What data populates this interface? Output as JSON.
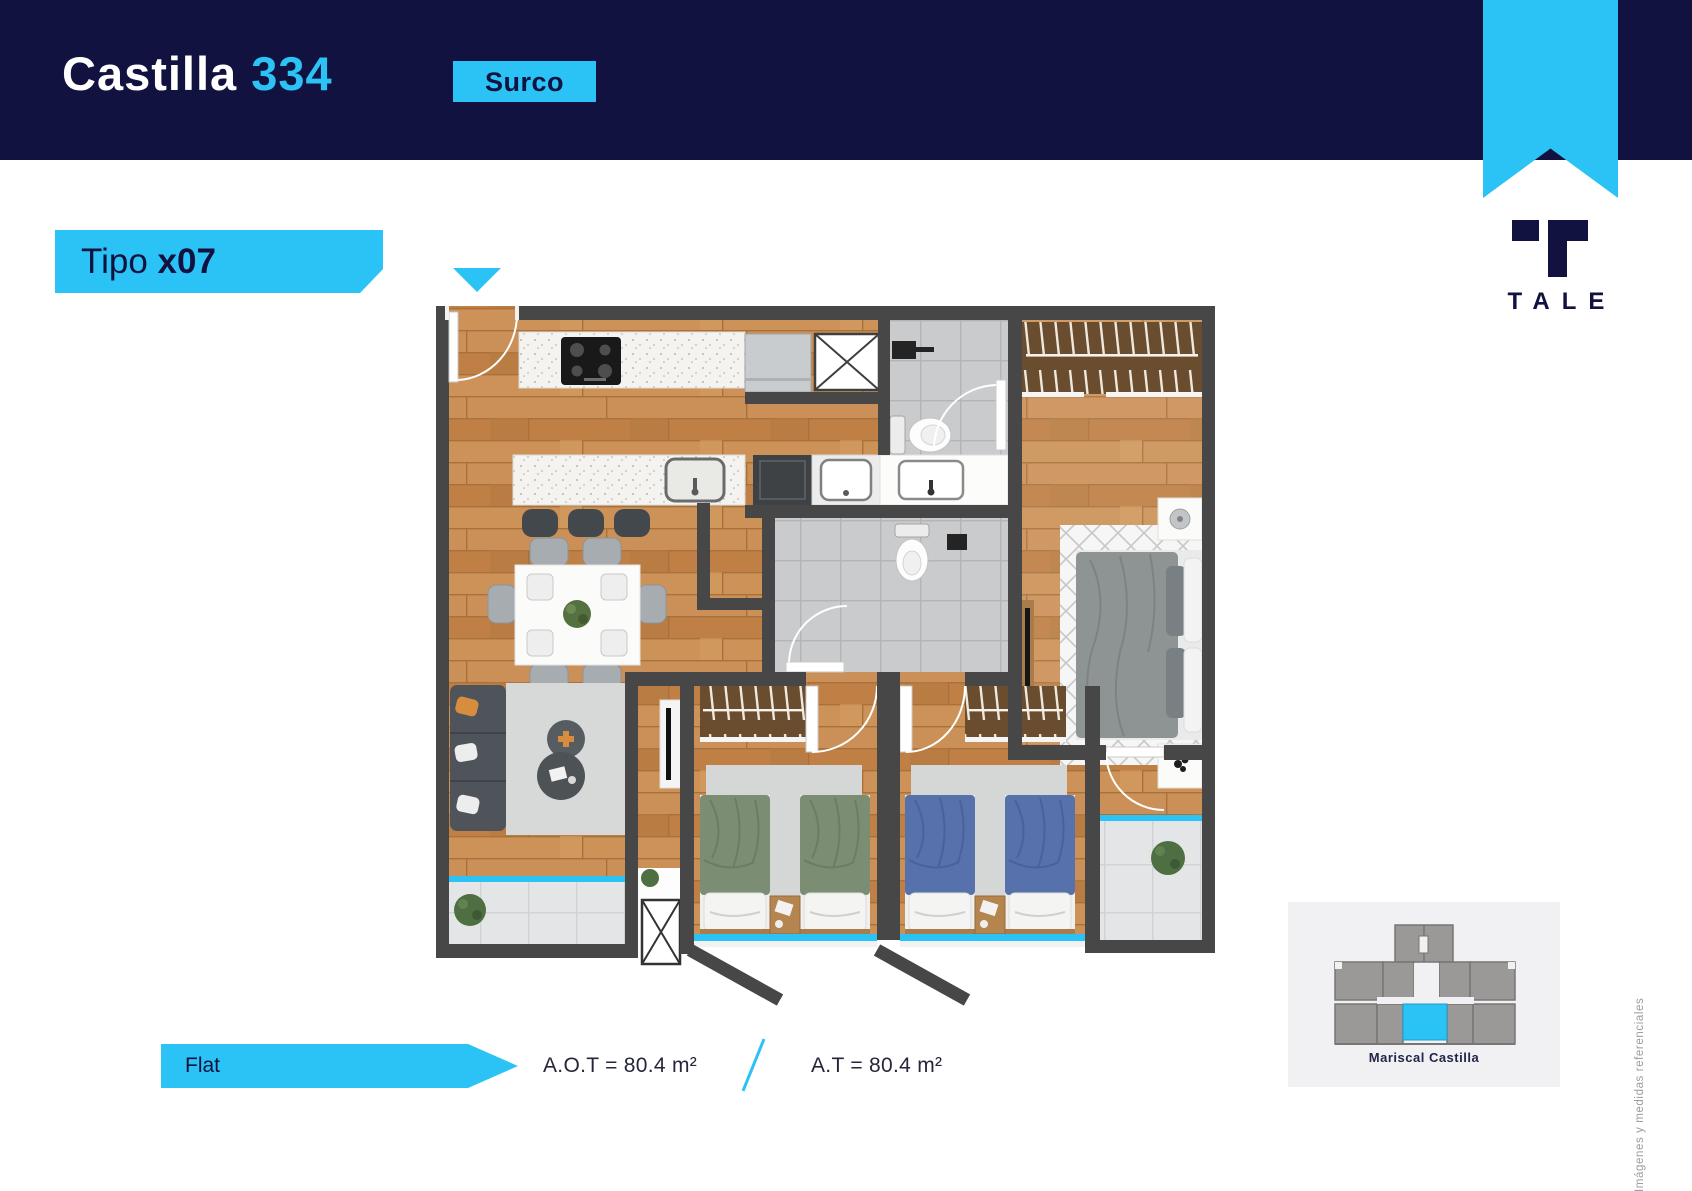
{
  "header": {
    "project_name": "Castilla",
    "project_number": "334",
    "district_badge": "Surco"
  },
  "unit": {
    "type_label": "Tipo",
    "type_code": "x07"
  },
  "brand": {
    "wordmark": "TALE",
    "emblem_icon": "t-block-icon",
    "ribbon_icon": "bookmark-ribbon"
  },
  "footer": {
    "plan_type": "Flat",
    "area_total_label": "A.O.T = 80.4 m²",
    "area_label": "A.T = 80.4 m²",
    "separator": "/"
  },
  "key_plan": {
    "caption": "Mariscal Castilla",
    "highlight_color": "#2bc3f5"
  },
  "disclaimer": "Imágenes y medidas referenciales",
  "colors": {
    "navy": "#11123f",
    "cyan": "#2bc3f5",
    "wall_gray": "#474747",
    "wood": "#c6894f",
    "bath_tile": "#c9cbcd",
    "balcony_tile": "#e4e5e6",
    "bed_green": "#7b8d73",
    "bed_blue": "#5671ab",
    "panel_bg": "#f1f0f2"
  }
}
